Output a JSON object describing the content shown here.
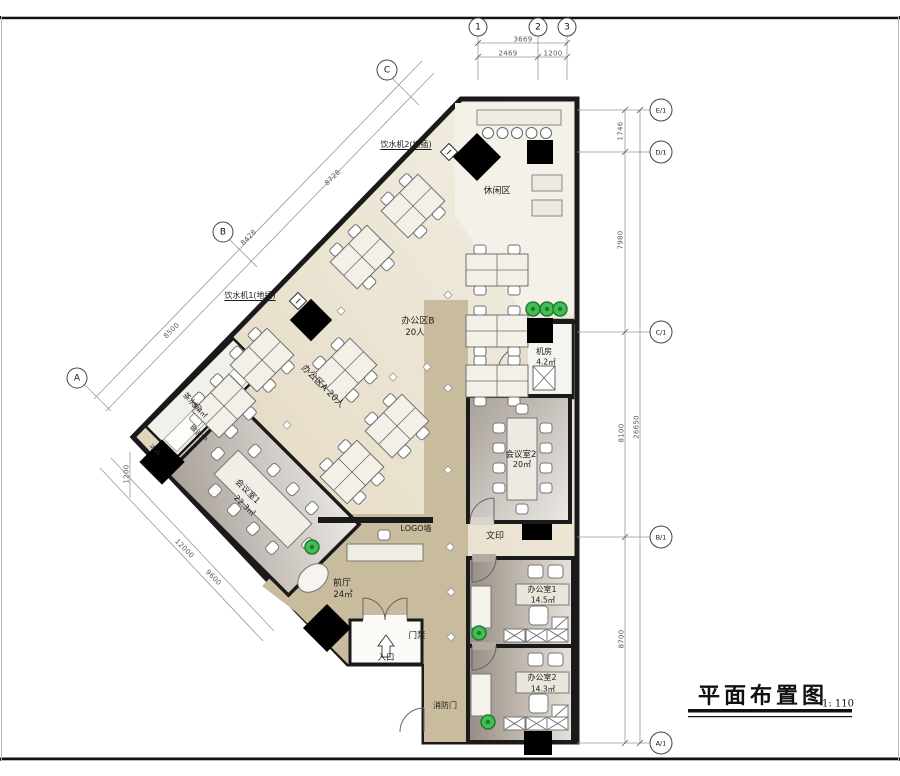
{
  "sheet": {
    "title": "平面布置图",
    "scale": "1: 110"
  },
  "grid_bubbles": {
    "top": [
      "1",
      "2",
      "3"
    ],
    "right": [
      "E/1",
      "D/1",
      "C/1",
      "B/1",
      "A/1"
    ],
    "diagonal": [
      "C",
      "B",
      "A"
    ]
  },
  "dimensions": {
    "top_total": "3669",
    "top_seg_1": "2469",
    "top_seg_2": "1200",
    "right_seg_1": "1746",
    "right_seg_2": "7980",
    "right_seg_3": "8100",
    "right_seg_4": "8700",
    "right_total": "26650",
    "diag_seg_1": "8728",
    "diag_seg_2": "8428",
    "diag_seg_3": "8500",
    "lower_seg_1": "12000",
    "lower_seg_2": "9600",
    "left_seg_1": "1200"
  },
  "rooms": {
    "leisure": {
      "name": "休闲区"
    },
    "office_b": {
      "name": "办公区B",
      "capacity": "20人"
    },
    "office_a": {
      "name": "办公区A  20人"
    },
    "server_room": {
      "name": "机房",
      "area": "4.2㎡"
    },
    "meeting_2": {
      "name": "会议室2",
      "area": "20㎡"
    },
    "meeting_1": {
      "name": "会议室1",
      "area": "22.3㎡"
    },
    "tea_room": {
      "name": "茶水间",
      "area": "5.4㎡"
    },
    "lobby": {
      "name": "前厅",
      "area": "24㎡"
    },
    "office_1": {
      "name": "办公室1",
      "area": "14.5㎡"
    },
    "office_2": {
      "name": "办公室2",
      "area": "14.3㎡"
    }
  },
  "annotations": {
    "water_2": "饮水机2(地插)",
    "water_1": "饮水机1(地插)",
    "logo_wall": "LOGO墙",
    "print": "文印",
    "access_door": "门禁",
    "entrance": "入口",
    "fire_door": "消防门",
    "microwave": "微波炉",
    "fridge": "冰箱"
  },
  "colors": {
    "wall": "#1a1a1a",
    "floor_light": "#f2eee1",
    "floor_tan": "#c9bc9e",
    "room_gradient_dark": "#978c84",
    "plant_green": "#45bd55",
    "column_black": "#000000"
  }
}
